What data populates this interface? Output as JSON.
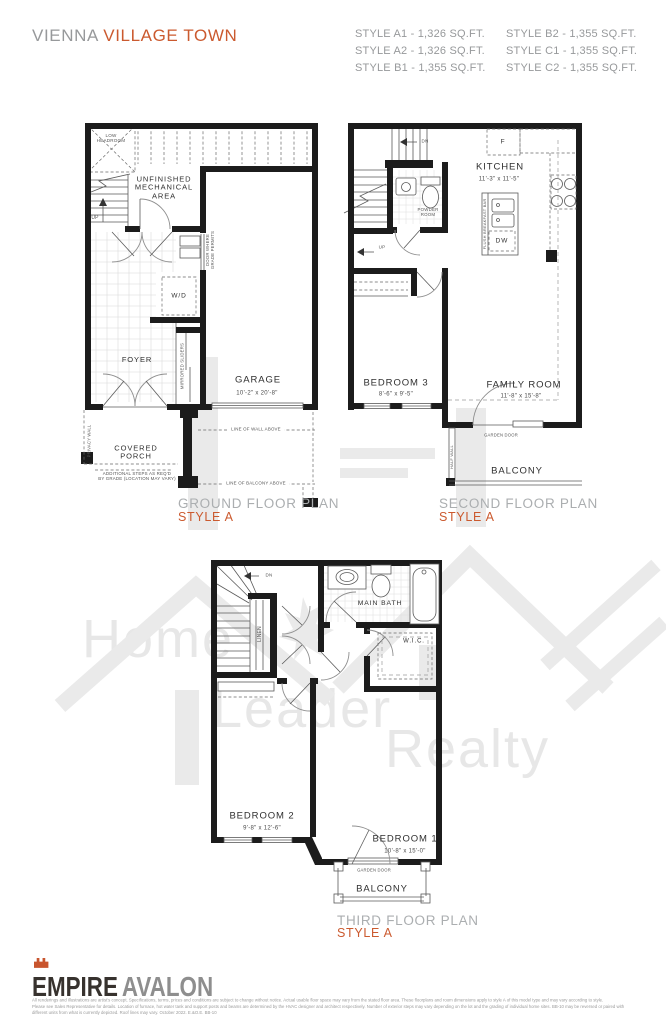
{
  "header": {
    "title": {
      "brand": "VIENNA",
      "model": "VILLAGE TOWN"
    },
    "styles": [
      "STYLE A1 - 1,326 SQ.FT.",
      "STYLE A2 - 1,326 SQ.FT.",
      "STYLE B1 - 1,355 SQ.FT.",
      "STYLE B2 - 1,355 SQ.FT.",
      "STYLE C1 - 1,355 SQ.FT.",
      "STYLE C2 - 1,355 SQ.FT."
    ]
  },
  "ground_floor": {
    "plan_title": "GROUND FLOOR PLAN",
    "plan_style": "STYLE A",
    "rooms": {
      "foyer": "FOYER",
      "garage": "GARAGE",
      "garage_dims": "10'-2\" x 20'-8\"",
      "wd": "W/D",
      "up": "UP"
    },
    "notes": {
      "low_headroom": [
        "LOW",
        "HEADROOM"
      ],
      "unfinished": [
        "UNFINISHED",
        "MECHANICAL",
        "AREA"
      ],
      "door_grade": [
        "DOOR WHERE",
        "GRADE PERMITS"
      ],
      "mirrored_sliders": "MIRRORED SLIDERS",
      "privacy_wall": "PRIVACY WALL",
      "covered_porch": [
        "COVERED",
        "PORCH"
      ],
      "additional_steps": [
        "ADDITIONAL STEPS AS REQ'D",
        "BY GRADE (LOCATION MAY VARY)"
      ],
      "line_of_wall": "LINE OF WALL ABOVE",
      "line_of_balcony": "LINE OF BALCONY ABOVE"
    }
  },
  "second_floor": {
    "plan_title": "SECOND FLOOR PLAN",
    "plan_style": "STYLE A",
    "rooms": {
      "kitchen": "KITCHEN",
      "kitchen_dims": "11'-3\" x 11'-5\"",
      "bedroom3": "BEDROOM 3",
      "bedroom3_dims": "8'-6\" x 9'-5\"",
      "family": "FAMILY ROOM",
      "family_dims": "11'-8\" x 15'-8\"",
      "balcony": "BALCONY",
      "powder": [
        "POWDER",
        "ROOM"
      ]
    },
    "notes": {
      "dn": "DN",
      "up": "UP",
      "fridge": "F",
      "dw": "DW",
      "flush_bar": "FLUSH BREAKFAST BAR",
      "garden_door": "GARDEN DOOR",
      "half_wall": "HALF WALL"
    }
  },
  "third_floor": {
    "plan_title": "THIRD FLOOR PLAN",
    "plan_style": "STYLE A",
    "rooms": {
      "bedroom2": "BEDROOM 2",
      "bedroom2_dims": "9'-8\" x 12'-6\"",
      "bedroom1": "BEDROOM 1",
      "bedroom1_dims": "10'-8\" x 15'-0\"",
      "main_bath": "MAIN BATH",
      "wic": "W.I.C.",
      "linen": "LINEN",
      "balcony": "BALCONY"
    },
    "notes": {
      "dn": "DN",
      "garden_door": "GARDEN DOOR"
    }
  },
  "watermark": {
    "words": [
      "Home",
      "Leader",
      "Realty"
    ]
  },
  "footer": {
    "logo": {
      "primary": "EMPIRE",
      "secondary": "AVALON"
    },
    "disclaimer": [
      "All renderings and illustrations are artist's concept. Specifications, terms, prices and conditions are subject to change without notice. Actual usable floor space may vary from the stated floor area. These floorplans and room dimensions apply to style A of this model type and may vary according to style.",
      "Please see Sales Representative for details. Location of furnace, hot water tank and support posts and beams are determined by the HVAC designer and architect respectively. Number of exterior steps may vary depending on the lot and the grading of individual home sites. BB-10 may be reversed or paired with",
      "different units from what is currently depicted. Roof lines may vary. October 2022. E.&O.E. BB-10"
    ]
  },
  "colors": {
    "accent": "#cb5a2f",
    "header_gray": "#97999b",
    "plan_title_gray": "#abaeb0",
    "wall": "#1c1c1c",
    "watermark": "#e9e9e9"
  }
}
